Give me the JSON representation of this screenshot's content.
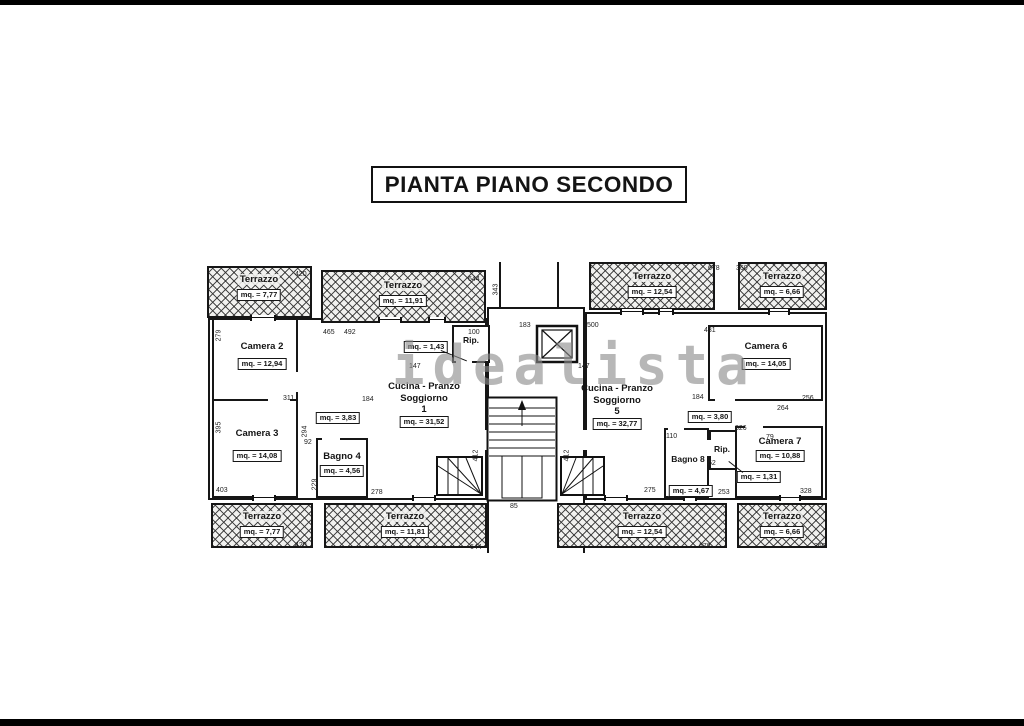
{
  "title": "PIANTA PIANO SECONDO",
  "watermark": "idealista",
  "terraces": {
    "tl1": {
      "name": "Terrazzo",
      "area": "mq. = 7,77"
    },
    "tl2": {
      "name": "Terrazzo",
      "area": "mq. = 11,91"
    },
    "tr1": {
      "name": "Terrazzo",
      "area": "mq. = 12,54"
    },
    "tr2": {
      "name": "Terrazzo",
      "area": "mq. = 6,66"
    },
    "bl1": {
      "name": "Terrazzo",
      "area": "mq. = 7,77"
    },
    "bl2": {
      "name": "Terrazzo",
      "area": "mq. = 11,81"
    },
    "br1": {
      "name": "Terrazzo",
      "area": "mq. = 12,54"
    },
    "br2": {
      "name": "Terrazzo",
      "area": "mq. = 6,66"
    }
  },
  "rooms": {
    "camera2": {
      "name": "Camera 2",
      "area": "mq. = 12,94"
    },
    "camera3": {
      "name": "Camera 3",
      "area": "mq. = 14,08"
    },
    "bagno4": {
      "name": "Bagno 4",
      "area": "mq. = 4,56"
    },
    "disimpegno1": {
      "area": "mq. = 3,83"
    },
    "rip1": {
      "name": "Rip.",
      "area": "mq. = 1,43"
    },
    "cucina1": {
      "line1": "Cucina - Pranzo",
      "line2": "Soggiorno",
      "number": "1",
      "area": "mq. = 31,52"
    },
    "cucina5": {
      "line1": "Cucina - Pranzo",
      "line2": "Soggiorno",
      "number": "5",
      "area": "mq. = 32,77"
    },
    "disimpegno5": {
      "area": "mq. = 3,80"
    },
    "bagno8": {
      "name": "Bagno 8",
      "area": "mq. = 4,67"
    },
    "rip5": {
      "name": "Rip.",
      "area": "mq. = 1,31"
    },
    "camera6": {
      "name": "Camera 6",
      "area": "mq. = 14,05"
    },
    "camera7": {
      "name": "Camera 7",
      "area": "mq. = 10,88"
    }
  },
  "dims": [
    "420",
    "644",
    "678",
    "360",
    "465",
    "492",
    "183",
    "500",
    "431",
    "100",
    "343",
    "279",
    "395",
    "311",
    "184",
    "92",
    "294",
    "229",
    "278",
    "403",
    "412",
    "412",
    "147",
    "147",
    "256",
    "264",
    "326",
    "79",
    "52",
    "253",
    "328",
    "275",
    "110",
    "184",
    "85",
    "420",
    "644",
    "678",
    "360"
  ]
}
